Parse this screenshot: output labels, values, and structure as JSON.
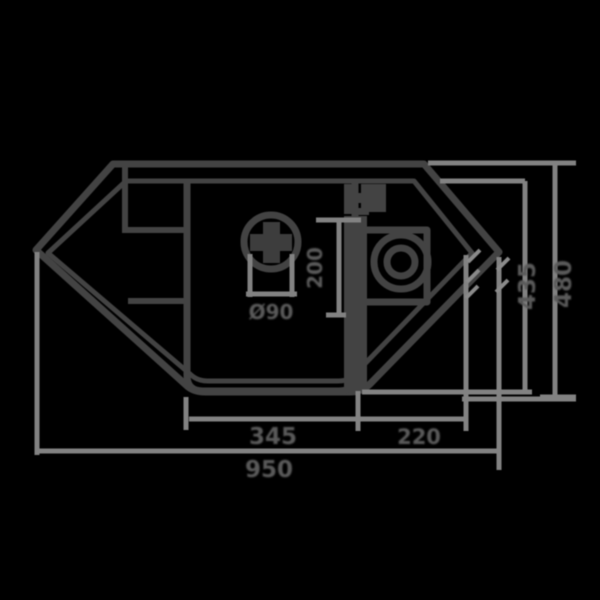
{
  "drawing": {
    "type": "technical-drawing",
    "subject": "corner kitchen sink top view with dimension lines"
  },
  "colors": {
    "background": "#000000",
    "outline": "#434343",
    "dimension_lines": "#828282",
    "label_text": "#5a5a5a"
  },
  "labels": {
    "bottom_bowl_width": "345",
    "bottom_right_width": "220",
    "overall_width": "950",
    "overall_depth": "480",
    "inner_depth": "435",
    "right_bowl_size": "200",
    "drain_diameter": "Ø90"
  }
}
